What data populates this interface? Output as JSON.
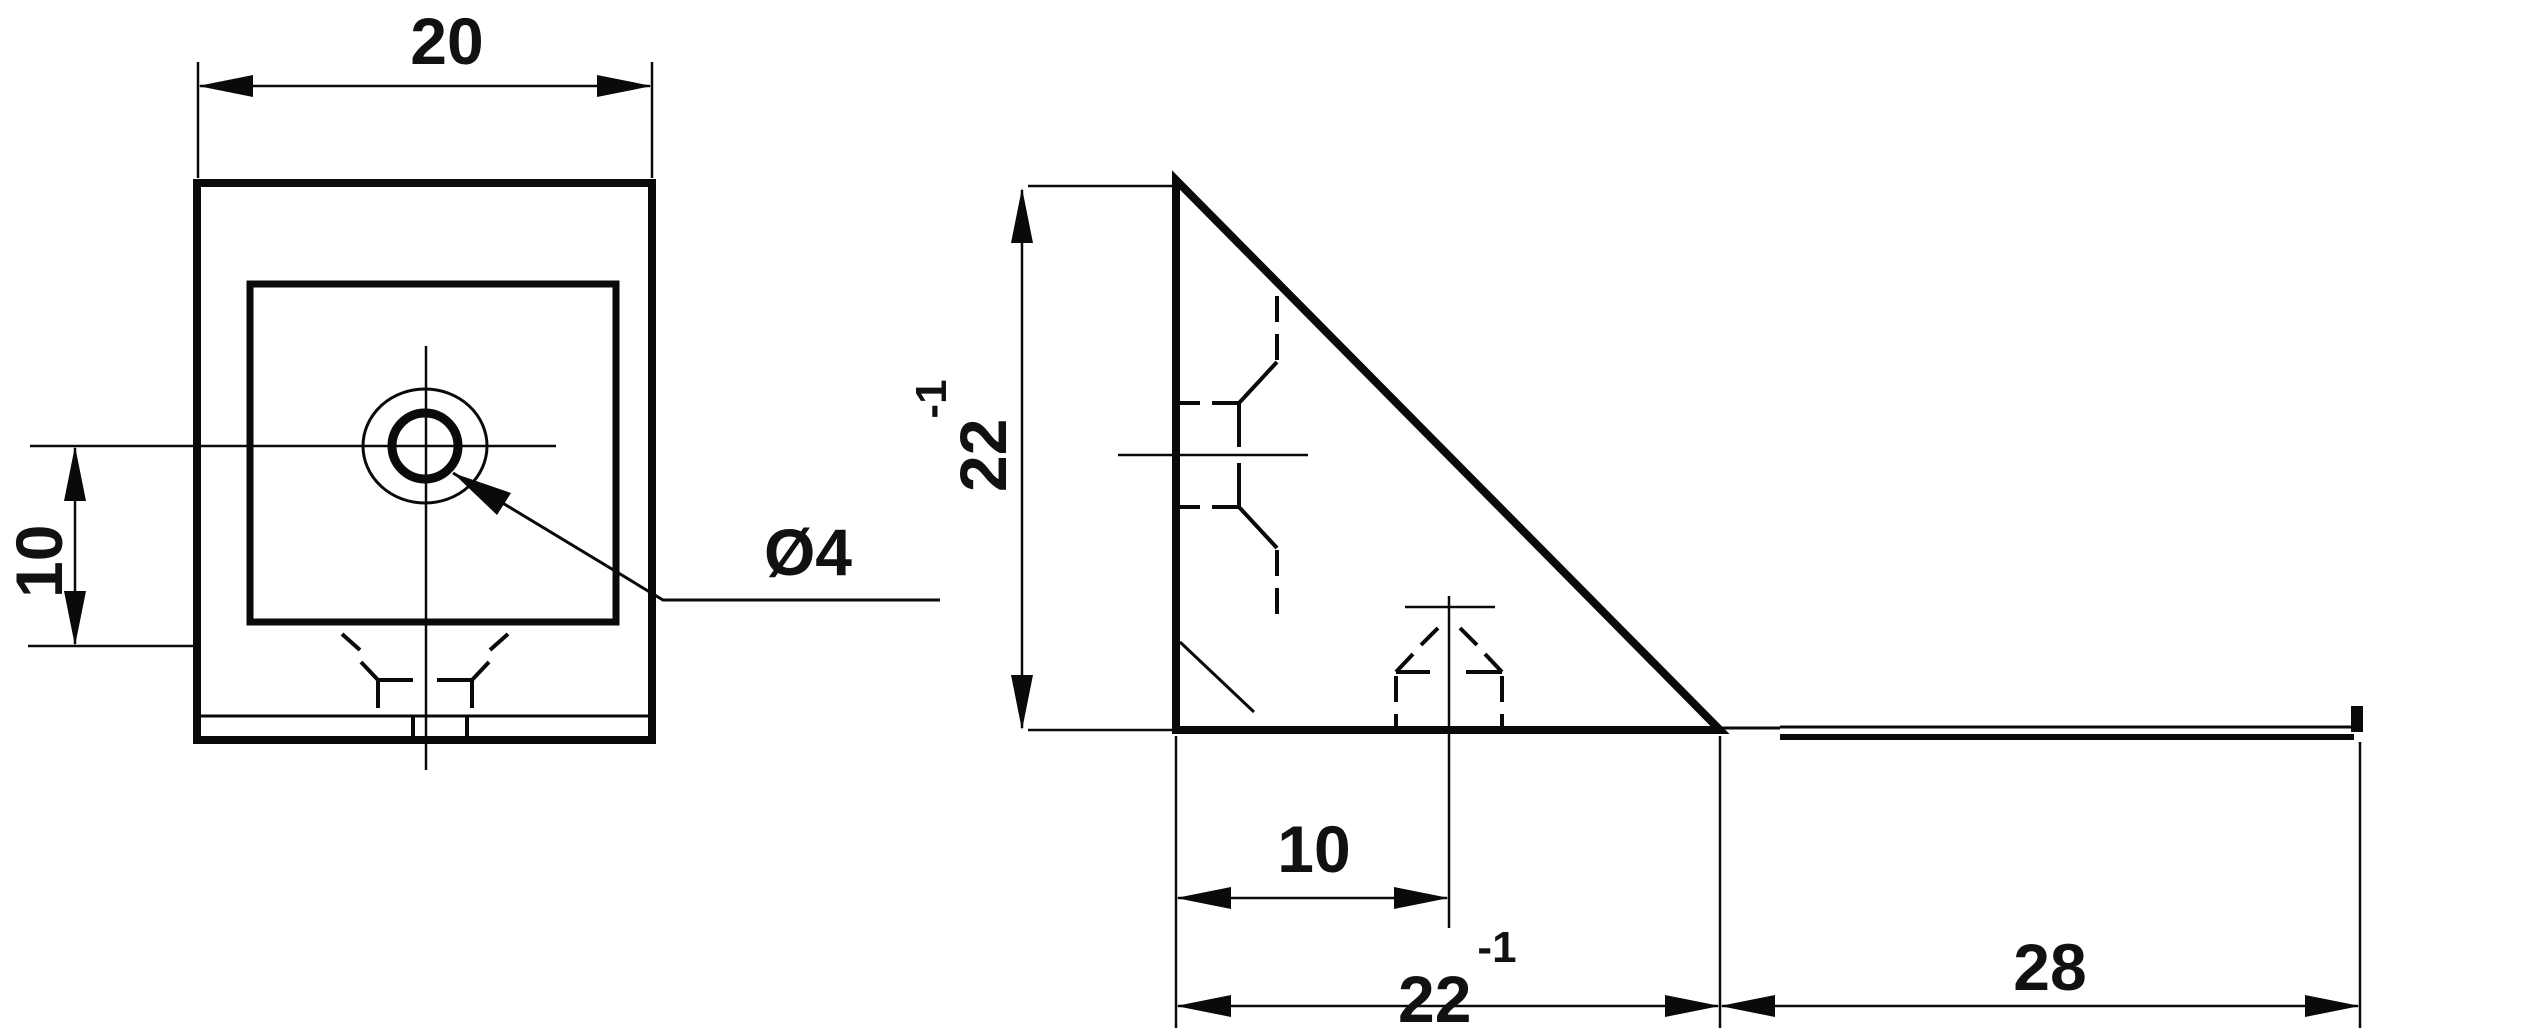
{
  "drawing": {
    "type": "technical-drawing",
    "background_color": "#ffffff",
    "line_color": "#0a0a0a",
    "views": {
      "front_view": {
        "name": "front-view",
        "features": [
          "outer-plate-outline",
          "inner-boss-outline",
          "countersink-circle",
          "hole-circle",
          "centerlines",
          "hidden-rib-lines",
          "base-plate-edge"
        ]
      },
      "side_view": {
        "name": "side-view",
        "features": [
          "gusset-triangle-outline",
          "flat-bar-strip",
          "hidden-hole-lines",
          "centerlines",
          "corner-chamfer-line"
        ]
      }
    },
    "dimensions": {
      "front_width": {
        "value": "20"
      },
      "front_hole_offset": {
        "value": "10"
      },
      "hole_diameter": {
        "value": "Ø4"
      },
      "side_height": {
        "value": "22",
        "tolerance": "-1"
      },
      "side_hole_offset": {
        "value": "10"
      },
      "side_base": {
        "value": "22",
        "tolerance": "-1"
      },
      "side_flat": {
        "value": "28"
      }
    }
  }
}
